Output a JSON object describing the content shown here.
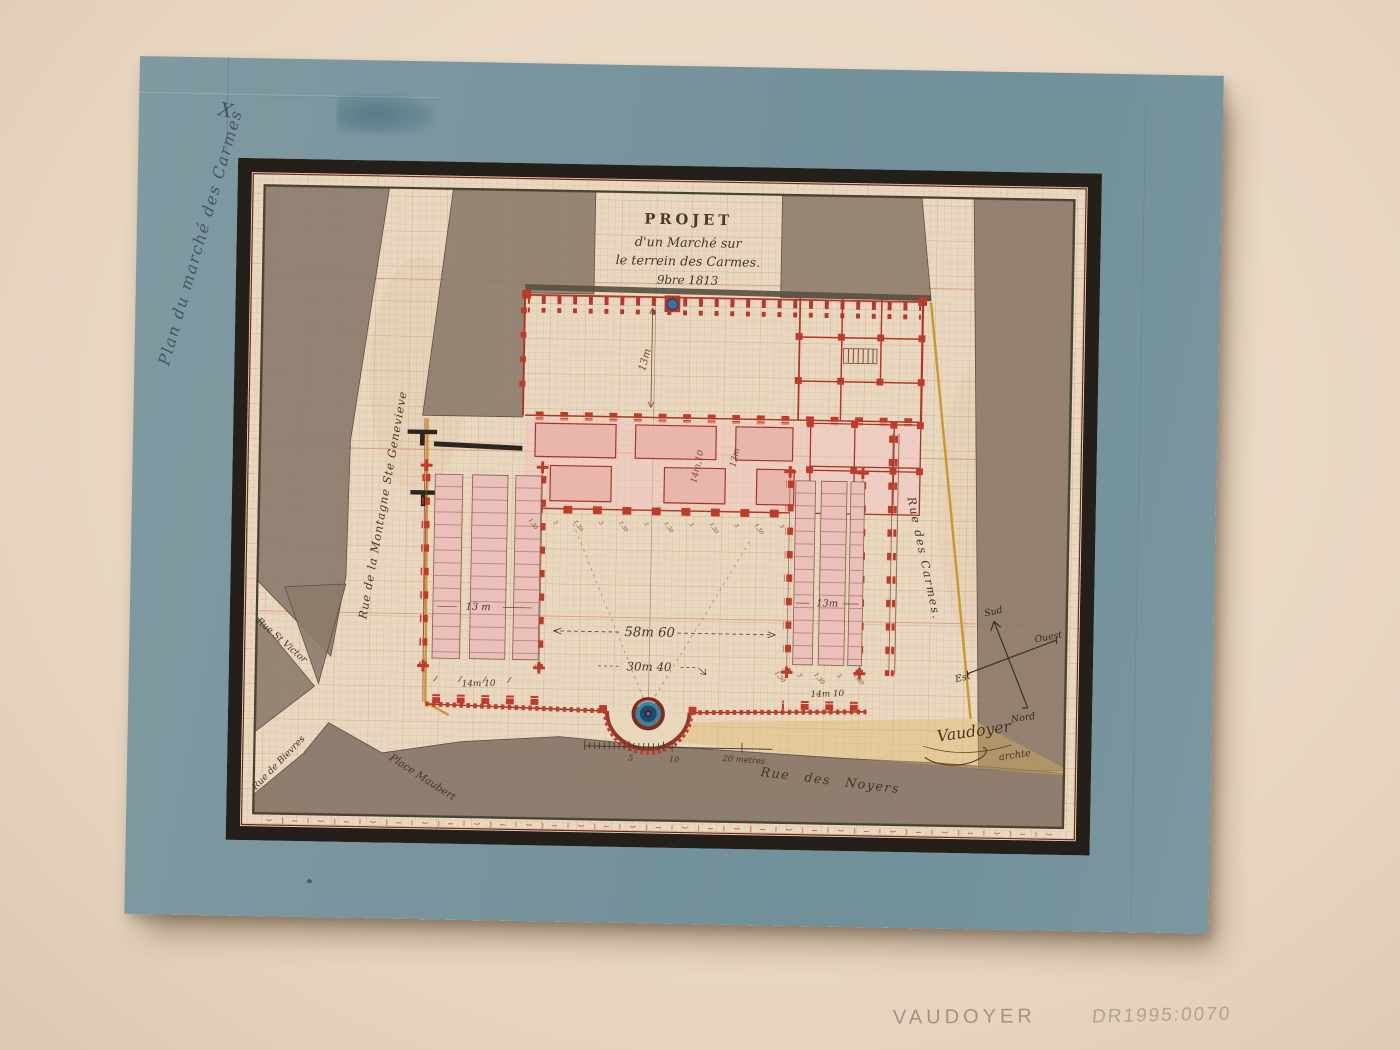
{
  "artwork": {
    "title": {
      "l1": "PROJET",
      "l2": "d'un Marché sur",
      "l3": "le terrein des Carmes.",
      "l4": "9bre 1813"
    },
    "streets": {
      "montagne": "Rue de la Montagne Ste Genevieve",
      "carmes": "Rue des Carmes.",
      "noyers": "Rue des Noyers",
      "victor": "Rue St Victor",
      "bievre": "Rue de Bievres",
      "maubert": "Place Maubert"
    },
    "dims": {
      "hall_depth": "13m",
      "gallery_a": "14m,10",
      "gallery_b": "13m",
      "court_w": "58m 60",
      "court_d": "30m 40",
      "wing_l": "13 m",
      "wing_r": "13m",
      "south_l": "14m 10",
      "south_r": "14m 10",
      "bay_a": "1,30",
      "bay_b": "3"
    },
    "scale": {
      "five": "5",
      "ten": "10",
      "twenty": "20 metres"
    },
    "compass": {
      "n": "Nord",
      "s": "Sud",
      "e": "Est",
      "w": "Ouest"
    },
    "signature": {
      "name": "Vaudoyer",
      "suffix": "archte"
    },
    "mount": {
      "inscription": "Plan du marché des Carmes",
      "mark": "X"
    },
    "mat": {
      "artist": "VAUDOYER",
      "accession": "DR1995:0070"
    }
  },
  "palette": {
    "mat_beige": "#ebdcc8",
    "mount_blue": "#78939c",
    "sheet_cream": "#e9d8c0",
    "wash_taupe": "#8d7b6c",
    "market_red": "#b5372c",
    "stall_pink": "#eac0b8",
    "plot_yellow": "#d8ae55",
    "basin_blue": "#3c6f9e",
    "frame_black": "#241f18"
  }
}
